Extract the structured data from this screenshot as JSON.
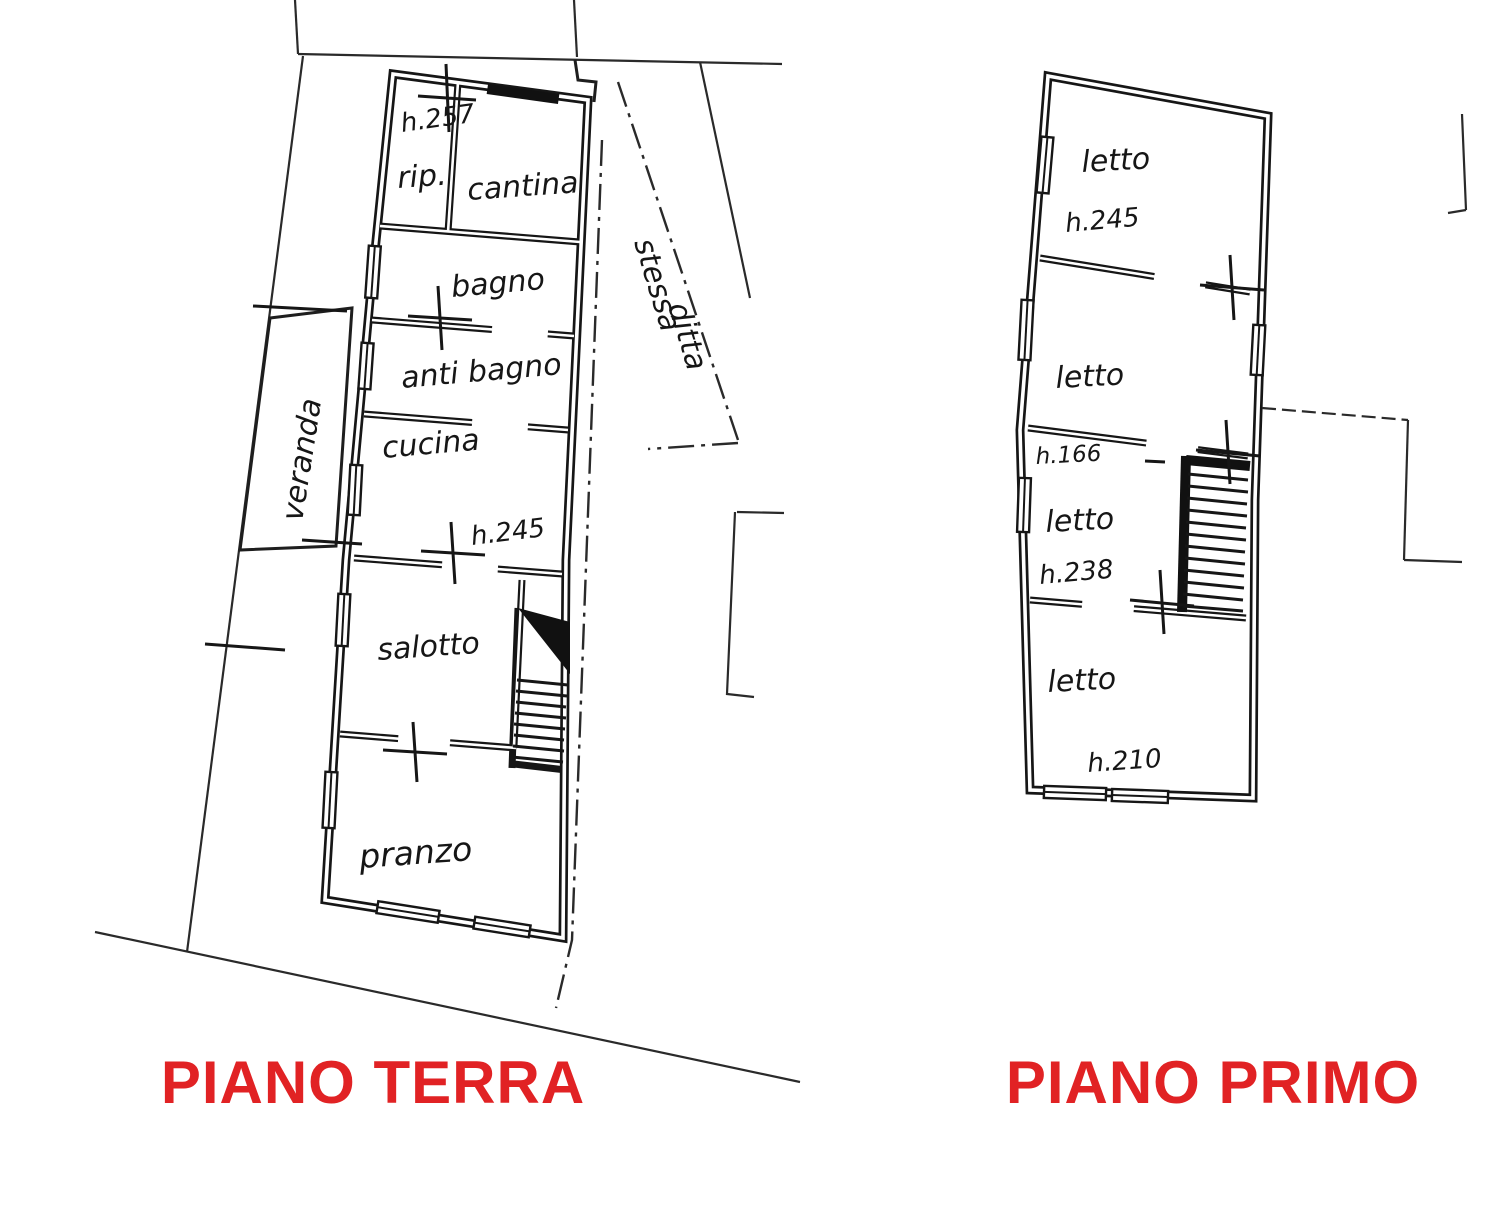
{
  "canvas": {
    "background": "#ffffff",
    "ink": "#161616"
  },
  "titles": {
    "ground_floor": "PIANO TERRA",
    "first_floor": "PIANO PRIMO",
    "color": "#e12224"
  },
  "ground_floor": {
    "rooms": [
      {
        "id": "rip",
        "label": "rip.",
        "height_note": "h.257"
      },
      {
        "id": "cantina",
        "label": "cantina"
      },
      {
        "id": "bagno",
        "label": "bagno"
      },
      {
        "id": "anti-bagno",
        "label": "anti bagno"
      },
      {
        "id": "cucina",
        "label": "cucina",
        "height_note": "h.245"
      },
      {
        "id": "salotto",
        "label": "salotto"
      },
      {
        "id": "pranzo",
        "label": "pranzo"
      },
      {
        "id": "veranda",
        "label": "veranda"
      }
    ],
    "boundary_note_line1": "stessa",
    "boundary_note_line2": "ditta"
  },
  "first_floor": {
    "rooms": [
      {
        "id": "letto-1",
        "label": "letto",
        "height_note": "h.245"
      },
      {
        "id": "letto-2",
        "label": "letto"
      },
      {
        "id": "letto-3",
        "label": "letto",
        "height_note": "h.238",
        "upper_note": "h.166"
      },
      {
        "id": "letto-4",
        "label": "letto",
        "height_note": "h.210"
      }
    ]
  }
}
